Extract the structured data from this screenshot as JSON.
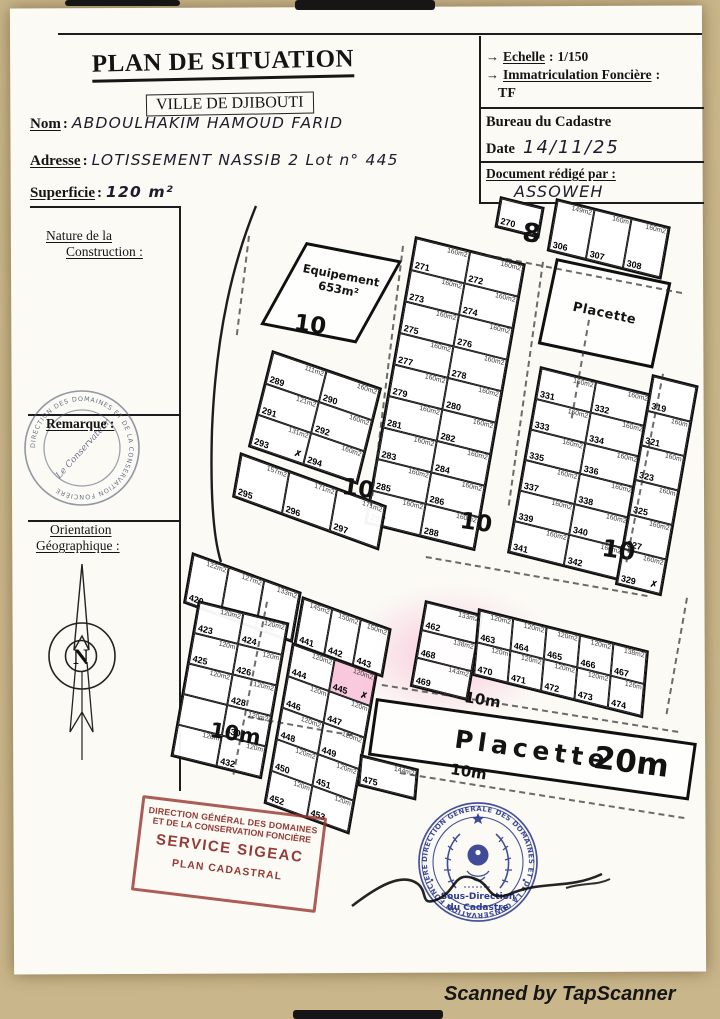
{
  "page": {
    "watermark": "Scanned by TapScanner",
    "colon": ":"
  },
  "header": {
    "title": "PLAN DE SITUATION",
    "city": "VILLE DE DJIBOUTI",
    "fields": [
      {
        "label": "Nom",
        "value": "ABDOULHAKIM HAMOUD FARID"
      },
      {
        "label": "Adresse",
        "value": "LOTISSEMENT NASSIB 2 Lot n° 445"
      },
      {
        "label": "Superficie",
        "value": "120 m²"
      }
    ]
  },
  "info_box": {
    "arrow": "→",
    "echelle_label": "Echelle",
    "echelle_value": "1/150",
    "immat_label": "Immatriculation Foncière",
    "immat_value": "TF",
    "bureau": "Bureau du Cadastre",
    "date_label": "Date",
    "date_value": "14/11/25",
    "redige_label": "Document rédigé par :",
    "redige_value": "ASSOWEH"
  },
  "sidebar": {
    "nature_line1": "Nature de la",
    "nature_line2": "Construction :",
    "remarque_label": "Remarque :",
    "stamp_ring_text": "DIRECTION DES DOMAINES ET DE LA CONSERVATION FONCIÈRE",
    "stamp_center_text": "Le Conservateur",
    "orientation_line1": "Orientation",
    "orientation_line2": "Géographique :",
    "compass_letter": "N"
  },
  "map": {
    "equipement_label": "Equipement",
    "equipement_area": "653m²",
    "placette_top": "Placette",
    "placette_bottom": "Placette",
    "street_labels": [
      {
        "id": "s8",
        "text": "8"
      },
      {
        "id": "s10a",
        "text": "10"
      },
      {
        "id": "s10b",
        "text": "10"
      },
      {
        "id": "s10c",
        "text": "10"
      },
      {
        "id": "s10d",
        "text": "10"
      },
      {
        "id": "s10ma",
        "text": "10m"
      },
      {
        "id": "s10mb",
        "text": "10m"
      },
      {
        "id": "s10mc",
        "text": "10m"
      },
      {
        "id": "s20m",
        "text": "20m"
      }
    ],
    "blocks": [
      {
        "id": "lot-270",
        "lots": [
          {
            "n": "270",
            "a": ""
          }
        ]
      },
      {
        "id": "row-306-308",
        "lots": [
          {
            "n": "306",
            "a": "149m2"
          },
          {
            "n": "307",
            "a": "160m"
          },
          {
            "n": "308",
            "a": "160m2"
          }
        ]
      },
      {
        "id": "block-271-288",
        "lots": [
          {
            "n": "271",
            "a": "160m2"
          },
          {
            "n": "272",
            "a": "160m2"
          },
          {
            "n": "273",
            "a": "160m2"
          },
          {
            "n": "274",
            "a": "160m2"
          },
          {
            "n": "275",
            "a": "160m2"
          },
          {
            "n": "276",
            "a": "160m2"
          },
          {
            "n": "277",
            "a": "160m2"
          },
          {
            "n": "278",
            "a": "160m2"
          },
          {
            "n": "279",
            "a": "160m2"
          },
          {
            "n": "280",
            "a": "160m2"
          },
          {
            "n": "281",
            "a": "160m2"
          },
          {
            "n": "282",
            "a": "160m2"
          },
          {
            "n": "283",
            "a": "160m2"
          },
          {
            "n": "284",
            "a": "160m2"
          },
          {
            "n": "285",
            "a": "160m2"
          },
          {
            "n": "286",
            "a": "160m2"
          },
          {
            "n": "287",
            "a": "160m2"
          },
          {
            "n": "288",
            "a": "160m2"
          }
        ]
      },
      {
        "id": "block-289-294",
        "lots": [
          {
            "n": "289",
            "a": "111m2"
          },
          {
            "n": "290",
            "a": "160m2"
          },
          {
            "n": "291",
            "a": "121m2"
          },
          {
            "n": "292",
            "a": "160m2"
          },
          {
            "n": "293",
            "a": "131m2",
            "x": true
          },
          {
            "n": "294",
            "a": "160m2"
          }
        ]
      },
      {
        "id": "block-295-297",
        "lots": [
          {
            "n": "295",
            "a": "157m2"
          },
          {
            "n": "296",
            "a": "171m2"
          },
          {
            "n": "297",
            "a": "171m2"
          }
        ]
      },
      {
        "id": "block-331-342",
        "lots": [
          {
            "n": "331",
            "a": "160m2"
          },
          {
            "n": "332",
            "a": "160m2"
          },
          {
            "n": "333",
            "a": "160m2"
          },
          {
            "n": "334",
            "a": "160m2"
          },
          {
            "n": "335",
            "a": "160m2"
          },
          {
            "n": "336",
            "a": "160m2"
          },
          {
            "n": "337",
            "a": "160m2"
          },
          {
            "n": "338",
            "a": "160m2"
          },
          {
            "n": "339",
            "a": "160m2"
          },
          {
            "n": "340",
            "a": "160m2"
          },
          {
            "n": "341",
            "a": "160m2"
          },
          {
            "n": "342",
            "a": "160m2"
          }
        ]
      },
      {
        "id": "col-319-329",
        "lots": [
          {
            "n": "319",
            "a": ""
          },
          {
            "n": "321",
            "a": "160m"
          },
          {
            "n": "323",
            "a": "160m"
          },
          {
            "n": "325",
            "a": "160m"
          },
          {
            "n": "327",
            "a": "160m2"
          },
          {
            "n": "329",
            "a": "160m2",
            "x": true
          }
        ]
      },
      {
        "id": "row-420-422",
        "lots": [
          {
            "n": "420",
            "a": "122m2"
          },
          {
            "n": "421",
            "a": "127m2"
          },
          {
            "n": "422",
            "a": "133m2"
          }
        ]
      },
      {
        "id": "block-423-432",
        "lots": [
          {
            "n": "423",
            "a": "120m2"
          },
          {
            "n": "424",
            "a": "120m2"
          },
          {
            "n": "425",
            "a": "120m"
          },
          {
            "n": "426",
            "a": "120m"
          },
          {
            "n": "",
            "a": "120m2"
          },
          {
            "n": "428",
            "a": "120m2"
          },
          {
            "n": "",
            "a": ""
          },
          {
            "n": "430",
            "a": "120m2"
          },
          {
            "n": "",
            "a": "120m"
          },
          {
            "n": "432",
            "a": "120m"
          }
        ]
      },
      {
        "id": "row-441-443",
        "lots": [
          {
            "n": "441",
            "a": "145m2"
          },
          {
            "n": "442",
            "a": "150m2"
          },
          {
            "n": "443",
            "a": "150m2"
          }
        ]
      },
      {
        "id": "block-444-453",
        "lots": [
          {
            "n": "444",
            "a": "120m2"
          },
          {
            "n": "445",
            "a": "120m2",
            "hl": true,
            "x": true
          },
          {
            "n": "446",
            "a": "120m"
          },
          {
            "n": "447",
            "a": "120m"
          },
          {
            "n": "448",
            "a": "120m2"
          },
          {
            "n": "449",
            "a": "120m2"
          },
          {
            "n": "450",
            "a": "120m2"
          },
          {
            "n": "451",
            "a": "120m2"
          },
          {
            "n": "452",
            "a": "120m"
          },
          {
            "n": "453",
            "a": "120m"
          }
        ]
      },
      {
        "id": "col-462-469",
        "lots": [
          {
            "n": "462",
            "a": "133m2"
          },
          {
            "n": "468",
            "a": "138m2"
          },
          {
            "n": "469",
            "a": "143m2"
          }
        ]
      },
      {
        "id": "block-463-474",
        "lots": [
          {
            "n": "463",
            "a": "120m2"
          },
          {
            "n": "464",
            "a": "120m2"
          },
          {
            "n": "465",
            "a": "120m2"
          },
          {
            "n": "466",
            "a": "120m2"
          },
          {
            "n": "467",
            "a": "138m2"
          },
          {
            "n": "470",
            "a": "120m"
          },
          {
            "n": "471",
            "a": "120m2"
          },
          {
            "n": "472",
            "a": "120m2"
          },
          {
            "n": "473",
            "a": "120m2"
          },
          {
            "n": "474",
            "a": "126m"
          }
        ]
      },
      {
        "id": "lot-475",
        "lots": [
          {
            "n": "475",
            "a": "144m2"
          }
        ]
      }
    ]
  },
  "stamps": {
    "red_lines": [
      "DIRECTION GÉNÉRAL DES DOMAINES",
      "ET DE LA CONSERVATION FONCIÈRE",
      "SERVICE SIGEAC",
      "PLAN CADASTRAL"
    ],
    "blue_ring_text": "DIRECTION GENERALE DES DOMAINES ET DE LA CONSERVATION FONCIERE",
    "blue_center_line1": "Sous-Direction",
    "blue_center_line2": "du Cadastre"
  }
}
